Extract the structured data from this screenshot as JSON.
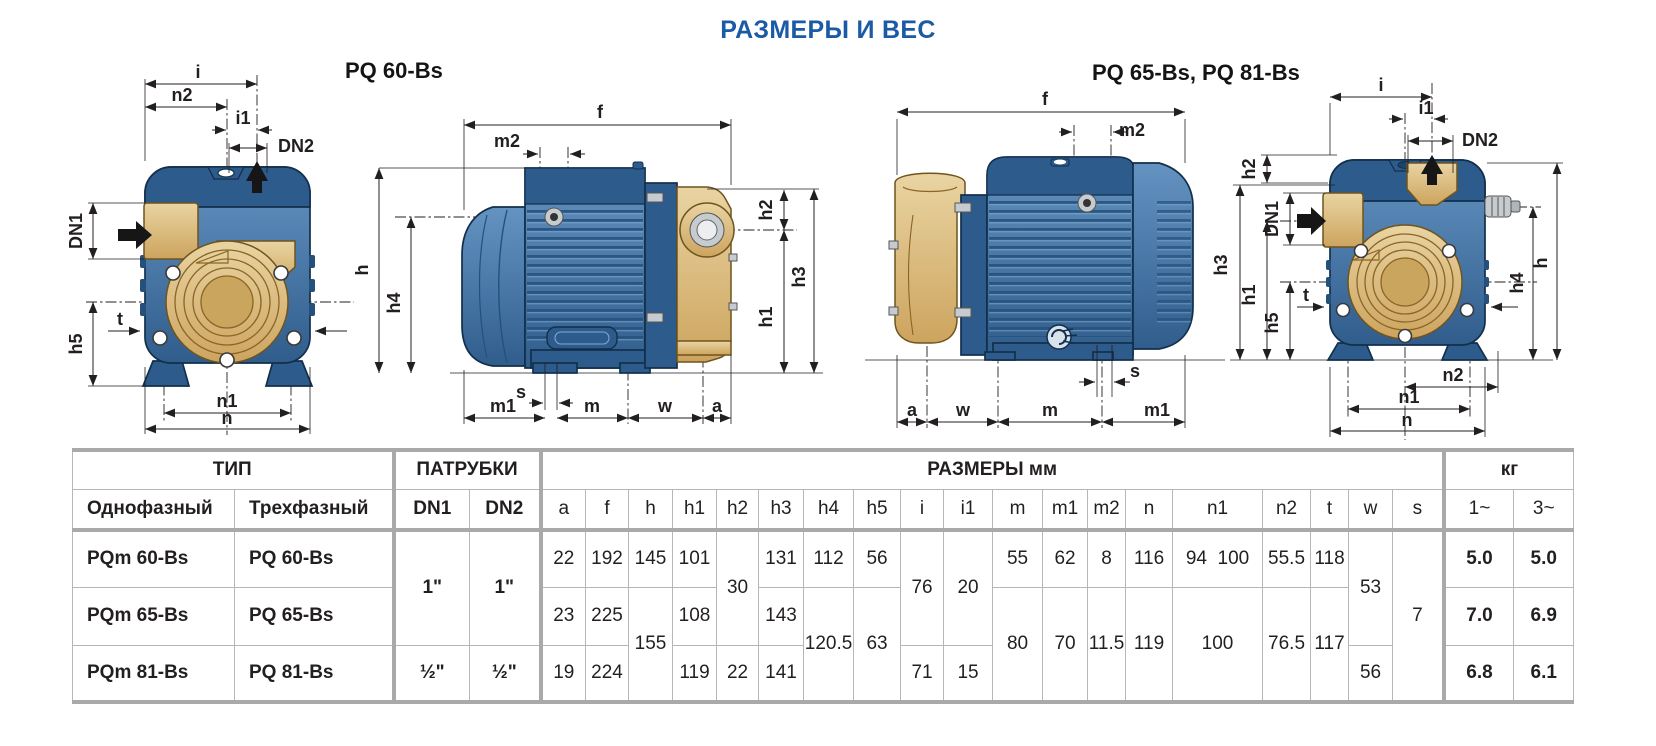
{
  "page": {
    "title": "РАЗМЕРЫ И ВЕС"
  },
  "colors": {
    "title_blue": "#1b5aa5",
    "pump_blue": "#3f6fa5",
    "pump_blue_dark": "#2d5b8b",
    "pump_gold": "#d7b272",
    "line": "#231f20",
    "table_border_thick": "#a9a9a9",
    "table_border_thin": "#b6b6b6"
  },
  "diagrams": {
    "left_title": "PQ 60-Bs",
    "right_title": "PQ 65-Bs, PQ 81-Bs",
    "labels": {
      "i": "i",
      "i1": "i1",
      "n": "n",
      "n1": "n1",
      "n2": "n2",
      "dn1": "DN1",
      "dn2": "DN2",
      "t": "t",
      "s": "s",
      "h": "h",
      "h1": "h1",
      "h2": "h2",
      "h3": "h3",
      "h4": "h4",
      "h5": "h5",
      "f": "f",
      "m": "m",
      "m1": "m1",
      "m2": "m2",
      "w": "w",
      "a": "a"
    }
  },
  "table": {
    "sections": {
      "type": "ТИП",
      "ports": "ПАТРУБКИ",
      "dimensions": "РАЗМЕРЫ мм",
      "weight": "кг"
    },
    "subheaders": {
      "single_phase": "Однофазный",
      "three_phase": "Трехфазный",
      "dn1": "DN1",
      "dn2": "DN2",
      "kg1": "1~",
      "kg3": "3~"
    },
    "dim_columns": [
      "a",
      "f",
      "h",
      "h1",
      "h2",
      "h3",
      "h4",
      "h5",
      "i",
      "i1",
      "m",
      "m1",
      "m2",
      "n",
      "n1",
      "n2",
      "t",
      "w",
      "s"
    ],
    "rows": [
      {
        "mono": "PQm 60-Bs",
        "tri": "PQ 60-Bs",
        "dn1": "1\"",
        "dn2": "1\"",
        "a": "22",
        "f": "192",
        "h": "145",
        "h1": "101",
        "h2": "30",
        "h3": "131",
        "h4": "112",
        "h5": "56",
        "i": "76",
        "i1": "20",
        "m": "55",
        "m1": "62",
        "m2": "8",
        "n": "116",
        "n1": "94  100",
        "n2": "55.5",
        "t": "118",
        "w": "53",
        "s": "7",
        "kg1": "5.0",
        "kg3": "5.0"
      },
      {
        "mono": "PQm 65-Bs",
        "tri": "PQ 65-Bs",
        "a": "23",
        "f": "225",
        "h": "155",
        "h1": "108",
        "h3": "143",
        "h4": "120.5",
        "h5": "63",
        "m": "80",
        "m1": "70",
        "m2": "11.5",
        "n": "119",
        "n1": "100",
        "n2": "76.5",
        "t": "117",
        "kg1": "7.0",
        "kg3": "6.9"
      },
      {
        "mono": "PQm 81-Bs",
        "tri": "PQ 81-Bs",
        "dn1": "½\"",
        "dn2": "½\"",
        "a": "19",
        "f": "224",
        "h1": "119",
        "h2": "22",
        "h3": "141",
        "i": "71",
        "i1": "15",
        "w": "56",
        "kg1": "6.8",
        "kg3": "6.1"
      }
    ]
  }
}
